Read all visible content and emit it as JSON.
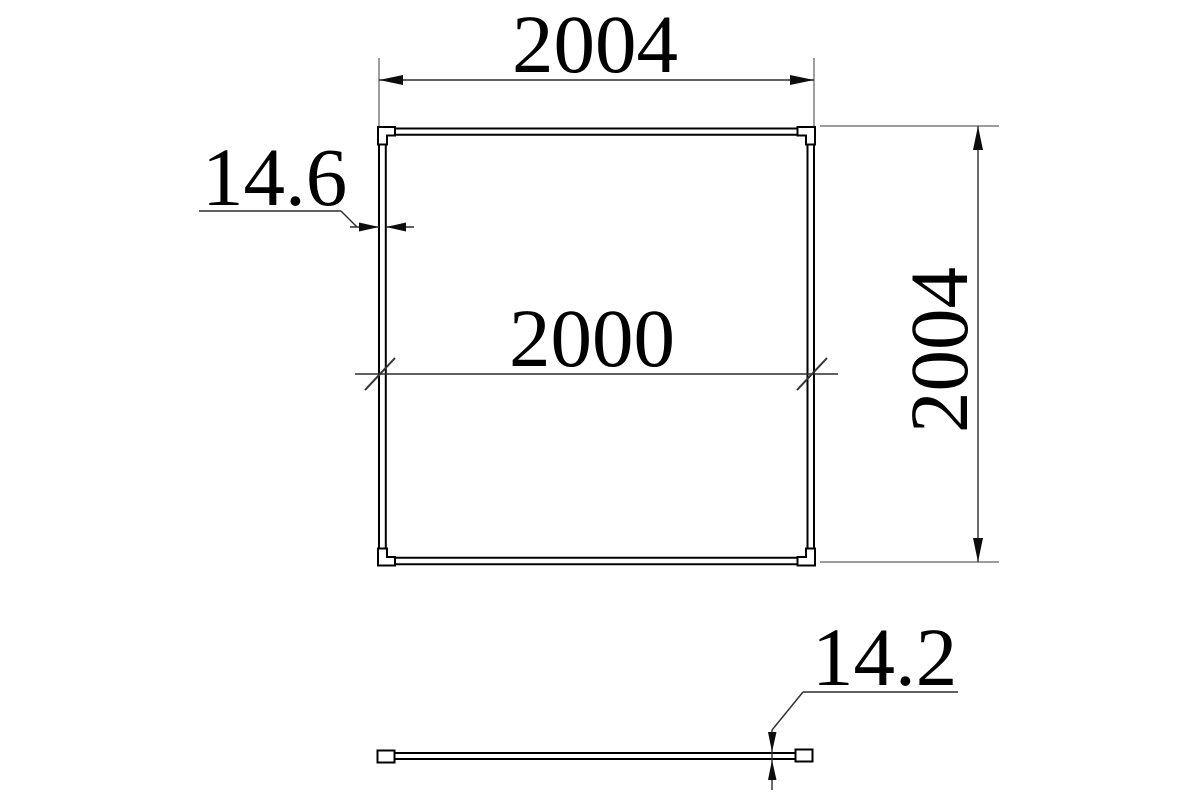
{
  "drawing": {
    "front_view": {
      "dim_outer_width": "2004",
      "dim_outer_height": "2004",
      "dim_inner_width": "2000",
      "dim_profile_thickness": "14.6"
    },
    "side_view": {
      "dim_panel_thickness": "14.2"
    },
    "colors": {
      "background": "#ffffff",
      "object_line": "#000000",
      "dimension_line": "#2d2d2d",
      "extension_line": "#7d7d7d",
      "text": "#000000"
    }
  }
}
